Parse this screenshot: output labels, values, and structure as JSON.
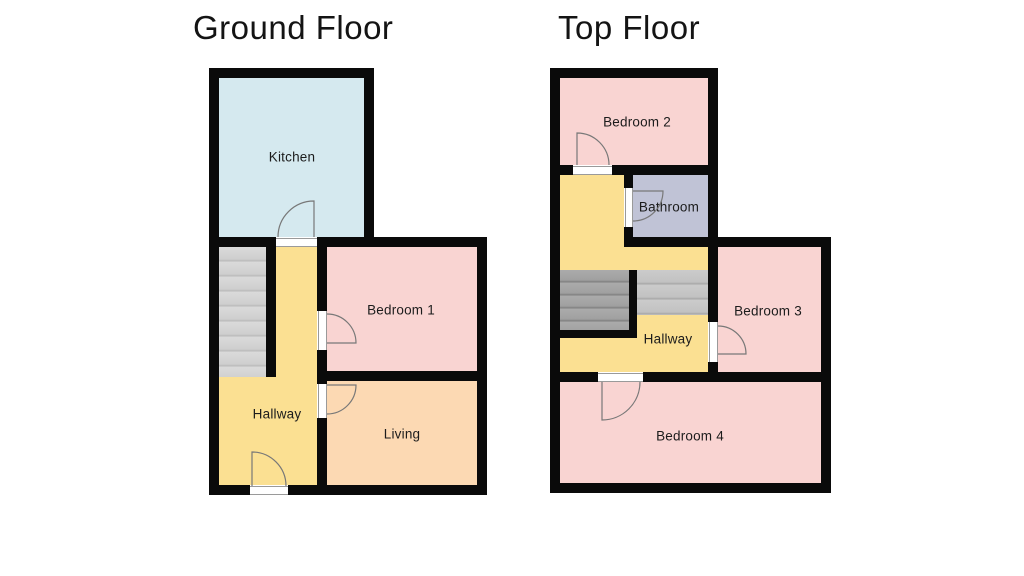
{
  "palette": {
    "wall": "#0a0a0a",
    "kitchen": "#d5e9ef",
    "bedroom": "#f9d4d2",
    "hallway": "#fbe092",
    "living": "#fcd9b3",
    "bathroom": "#c0c3d6",
    "door_line": "#787878",
    "label": "#1c1c1c"
  },
  "floors": [
    {
      "title": "Ground Floor",
      "rooms": [
        {
          "label": "Kitchen"
        },
        {
          "label": "Bedroom 1"
        },
        {
          "label": "Hallway"
        },
        {
          "label": "Living"
        }
      ]
    },
    {
      "title": "Top Floor",
      "rooms": [
        {
          "label": "Bedroom 2"
        },
        {
          "label": "Bathroom"
        },
        {
          "label": "Bedroom 3"
        },
        {
          "label": "Hallway"
        },
        {
          "label": "Bedroom 4"
        }
      ]
    }
  ]
}
